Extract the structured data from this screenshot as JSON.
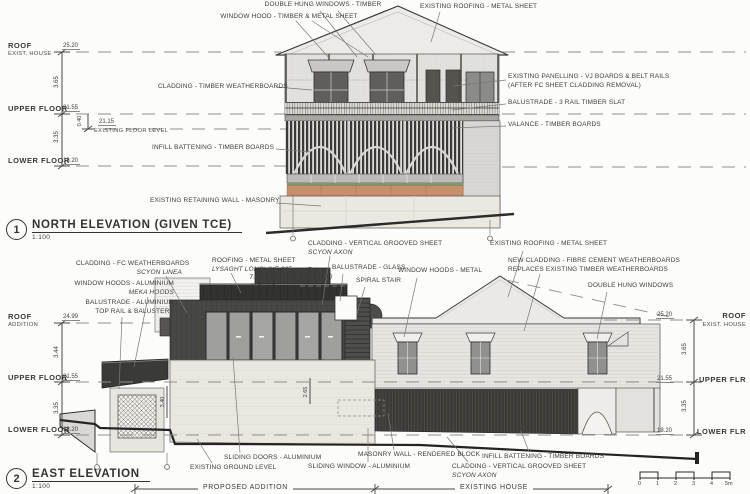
{
  "north": {
    "number": "1",
    "title": "NORTH ELEVATION (GIVEN TCE)",
    "scale": "1:100",
    "levels": {
      "roof": "ROOF",
      "roof_sub": "EXIST. HOUSE",
      "roof_rl": "25.20",
      "upper": "UPPER FLOOR",
      "upper_rl": "21.55",
      "lower": "LOWER FLOOR",
      "lower_rl": "18.20",
      "efl": "EXISTING FLOOR LEVEL",
      "efl_rl": "21.15",
      "dim_roof_upper": "3.65",
      "dim_upper_efl": "0.40",
      "dim_upper_lower": "3.35"
    },
    "callouts": {
      "double_hung": "DOUBLE HUNG WINDOWS - TIMBER",
      "window_hood": "WINDOW HOOD - TIMBER & METAL SHEET",
      "existing_roofing": "EXISTING ROOFING - METAL SHEET",
      "cladding": "CLADDING - TIMBER WEATHERBOARDS",
      "panelling_1": "EXISTING PANELLING - VJ BOARDS & BELT RAILS",
      "panelling_2": "(AFTER FC SHEET CLADDING REMOVAL)",
      "balustrade": "BALUSTRADE - 3 RAIL TIMBER SLAT",
      "valance": "VALANCE - TIMBER BOARDS",
      "infill": "INFILL BATTENING - TIMBER BOARDS",
      "retaining": "EXISTING RETAINING WALL - MASONRY"
    }
  },
  "east": {
    "number": "2",
    "title": "EAST ELEVATION",
    "scale": "1:100",
    "levels_left": {
      "roof": "ROOF",
      "roof_sub": "ADDITION",
      "roof_rl": "24.99",
      "upper": "UPPER FLOOR",
      "upper_rl": "21.55",
      "lower": "LOWER FLOOR",
      "lower_rl": "18.20",
      "dim_top": "3.44",
      "dim_bottom": "3.35"
    },
    "levels_right": {
      "roof": "ROOF",
      "roof_sub": "EXIST. HOUSE",
      "roof_rl": "25.20",
      "upper": "UPPER FLR",
      "upper_rl": "21.55",
      "lower": "LOWER FLR",
      "lower_rl": "18.20",
      "dim_top": "3.65",
      "dim_bottom": "3.35"
    },
    "dims": {
      "masonry_left": "3.40",
      "masonry_right": "2.65"
    },
    "callouts": {
      "cladding_fc_1": "CLADDING - FC WEATHERBOARDS",
      "cladding_fc_2": "SCYON LINEA",
      "window_hoods_alum_1": "WINDOW HOODS - ALUMINIUM",
      "window_hoods_alum_2": "MEKA HOODS",
      "balustrade_alum_1": "BALUSTRADE - ALUMINIUM",
      "balustrade_alum_2": "TOP RAIL & BALUSTERS",
      "roofing_1": "ROOFING - METAL SHEET",
      "roofing_2": "LYSAGHT LONGLINE 305",
      "wall_height_1": "7.5M WALL HEIGHT",
      "wall_height_2": "(ABOVE GROUND LEVEL)",
      "cladding_vgs_1": "CLADDING - VERTICAL GROOVED SHEET",
      "cladding_vgs_2": "SCYON AXON",
      "existing_roofing": "EXISTING ROOFING - METAL SHEET",
      "balustrade_glass": "BALUSTRADE - GLASS",
      "spiral_stair": "SPIRAL STAIR",
      "window_hoods_metal": "WINDOW HOODS - METAL",
      "new_cladding_1": "NEW CLADDING - FIBRE CEMENT WEATHERBOARDS",
      "new_cladding_2": "REPLACES EXISTING TIMBER WEATHERBOARDS",
      "double_hung": "DOUBLE HUNG WINDOWS",
      "sliding_doors": "SLIDING DOORS - ALUMINIUM",
      "ground_level": "EXISTING GROUND LEVEL",
      "sliding_window": "SLIDING WINDOW - ALUMINIUM",
      "masonry_wall": "MASONRY WALL - RENDERED BLOCK",
      "infill": "INFILL BATTENING - TIMBER BOARDS",
      "cladding_vgs_b1": "CLADDING - VERTICAL GROOVED SHEET",
      "cladding_vgs_b2": "SCYON AXON"
    },
    "spans": {
      "proposed": "PROPOSED ADDITION",
      "existing": "EXISTING HOUSE"
    },
    "scalebar": [
      "0",
      "1",
      "2",
      "3",
      "4",
      "5m"
    ]
  }
}
